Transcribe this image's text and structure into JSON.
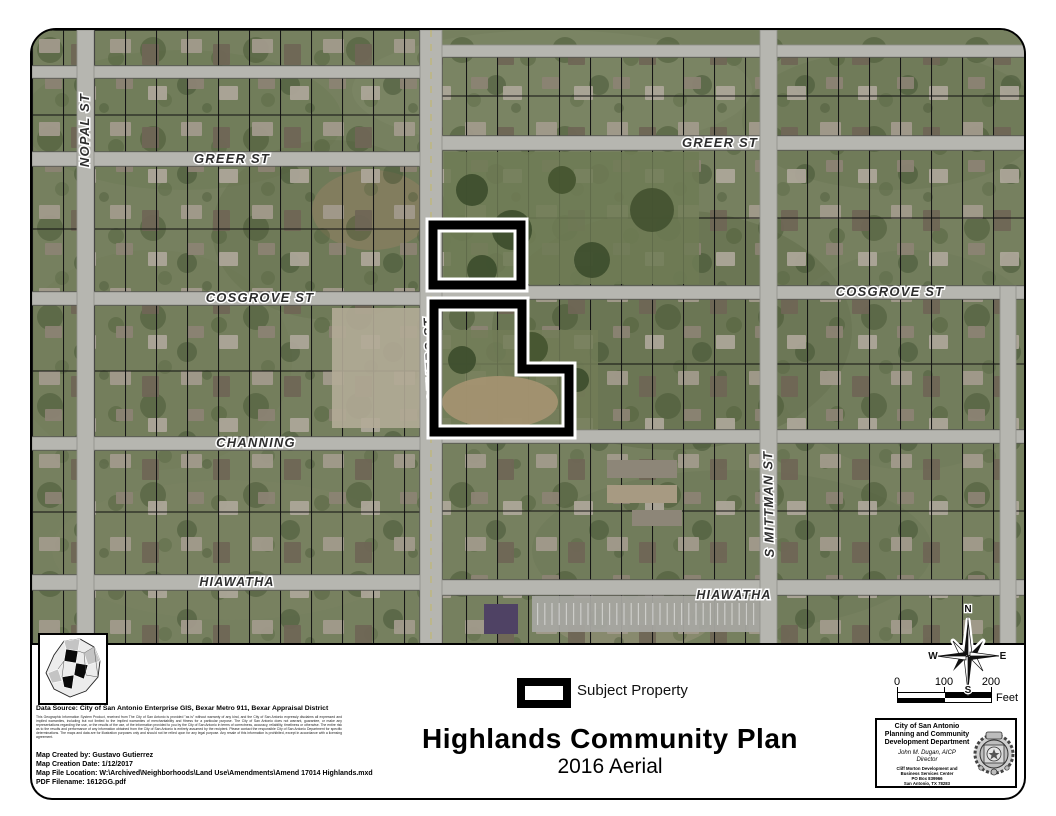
{
  "map": {
    "street_labels": {
      "nopal": "NOPAL ST",
      "greer_left": "GREER ST",
      "greer_right": "GREER ST",
      "cosgrove_left": "COSGROVE ST",
      "cosgrove_right": "COSGROVE ST",
      "gevers": "S GEVERS ST",
      "channing": "CHANNING",
      "mittman": "S MITTMAN ST",
      "hiawatha_left": "HIAWATHA",
      "hiawatha_right": "HIAWATHA"
    },
    "subject_property_color": "#000000"
  },
  "legend": {
    "subject_property_label": "Subject Property"
  },
  "title": {
    "main": "Highlands Community Plan",
    "subtitle": "2016 Aerial"
  },
  "compass": {
    "n": "N",
    "e": "E",
    "s": "S",
    "w": "W"
  },
  "scalebar": {
    "tick_0": "0",
    "tick_100": "100",
    "tick_200": "200",
    "unit": "Feet"
  },
  "credits": {
    "data_source": "Data Source: City of San Antonio Enterprise GIS, Bexar Metro 911, Bexar Appraisal District",
    "disclaimer": "This Geographic Information System Product, received from The City of San Antonio is provided \"as is\" without warranty of any kind, and the City of San Antonio expressly disclaims all expressed and implied warranties, including but not limited to the implied warranties of merchantability and fitness for a particular purpose. The City of San Antonio does not warrant, guarantee, or make any representations regarding the use, or the results of the use, of the information provided to you by the City of San Antonio in terms of correctness, accuracy, reliability, timeliness or otherwise. The entire risk as to the results and performance of any information obtained from the City of San Antonio is entirely assumed by the recipient. Please contact the responsible City of San Antonio Department for specific determinations. The maps and data are for illustration purposes only and should not be relied upon for any legal purpose. Any resale of this information is prohibited, except in accordance with a licensing agreement.",
    "created_by": "Map Created by: Gustavo Gutierrez",
    "creation_date": "Map Creation Date: 1/12/2017",
    "file_location": "Map File Location: W:\\Archived\\Neighborhoods\\Land Use\\Amendments\\Amend 17014 Highlands.mxd",
    "pdf_filename": "PDF Filename: 1612GG.pdf"
  },
  "agency": {
    "city": "City of San Antonio",
    "dept_line1": "Planning and Community",
    "dept_line2": "Development Department",
    "director_name": "John M. Dugan, AICP",
    "director_title": "Director",
    "address_line1": "Cliff Morton Development and",
    "address_line2": "Business Services Center",
    "address_line3": "PO Box 839966",
    "address_line4": "San Antonio, TX 78283"
  }
}
